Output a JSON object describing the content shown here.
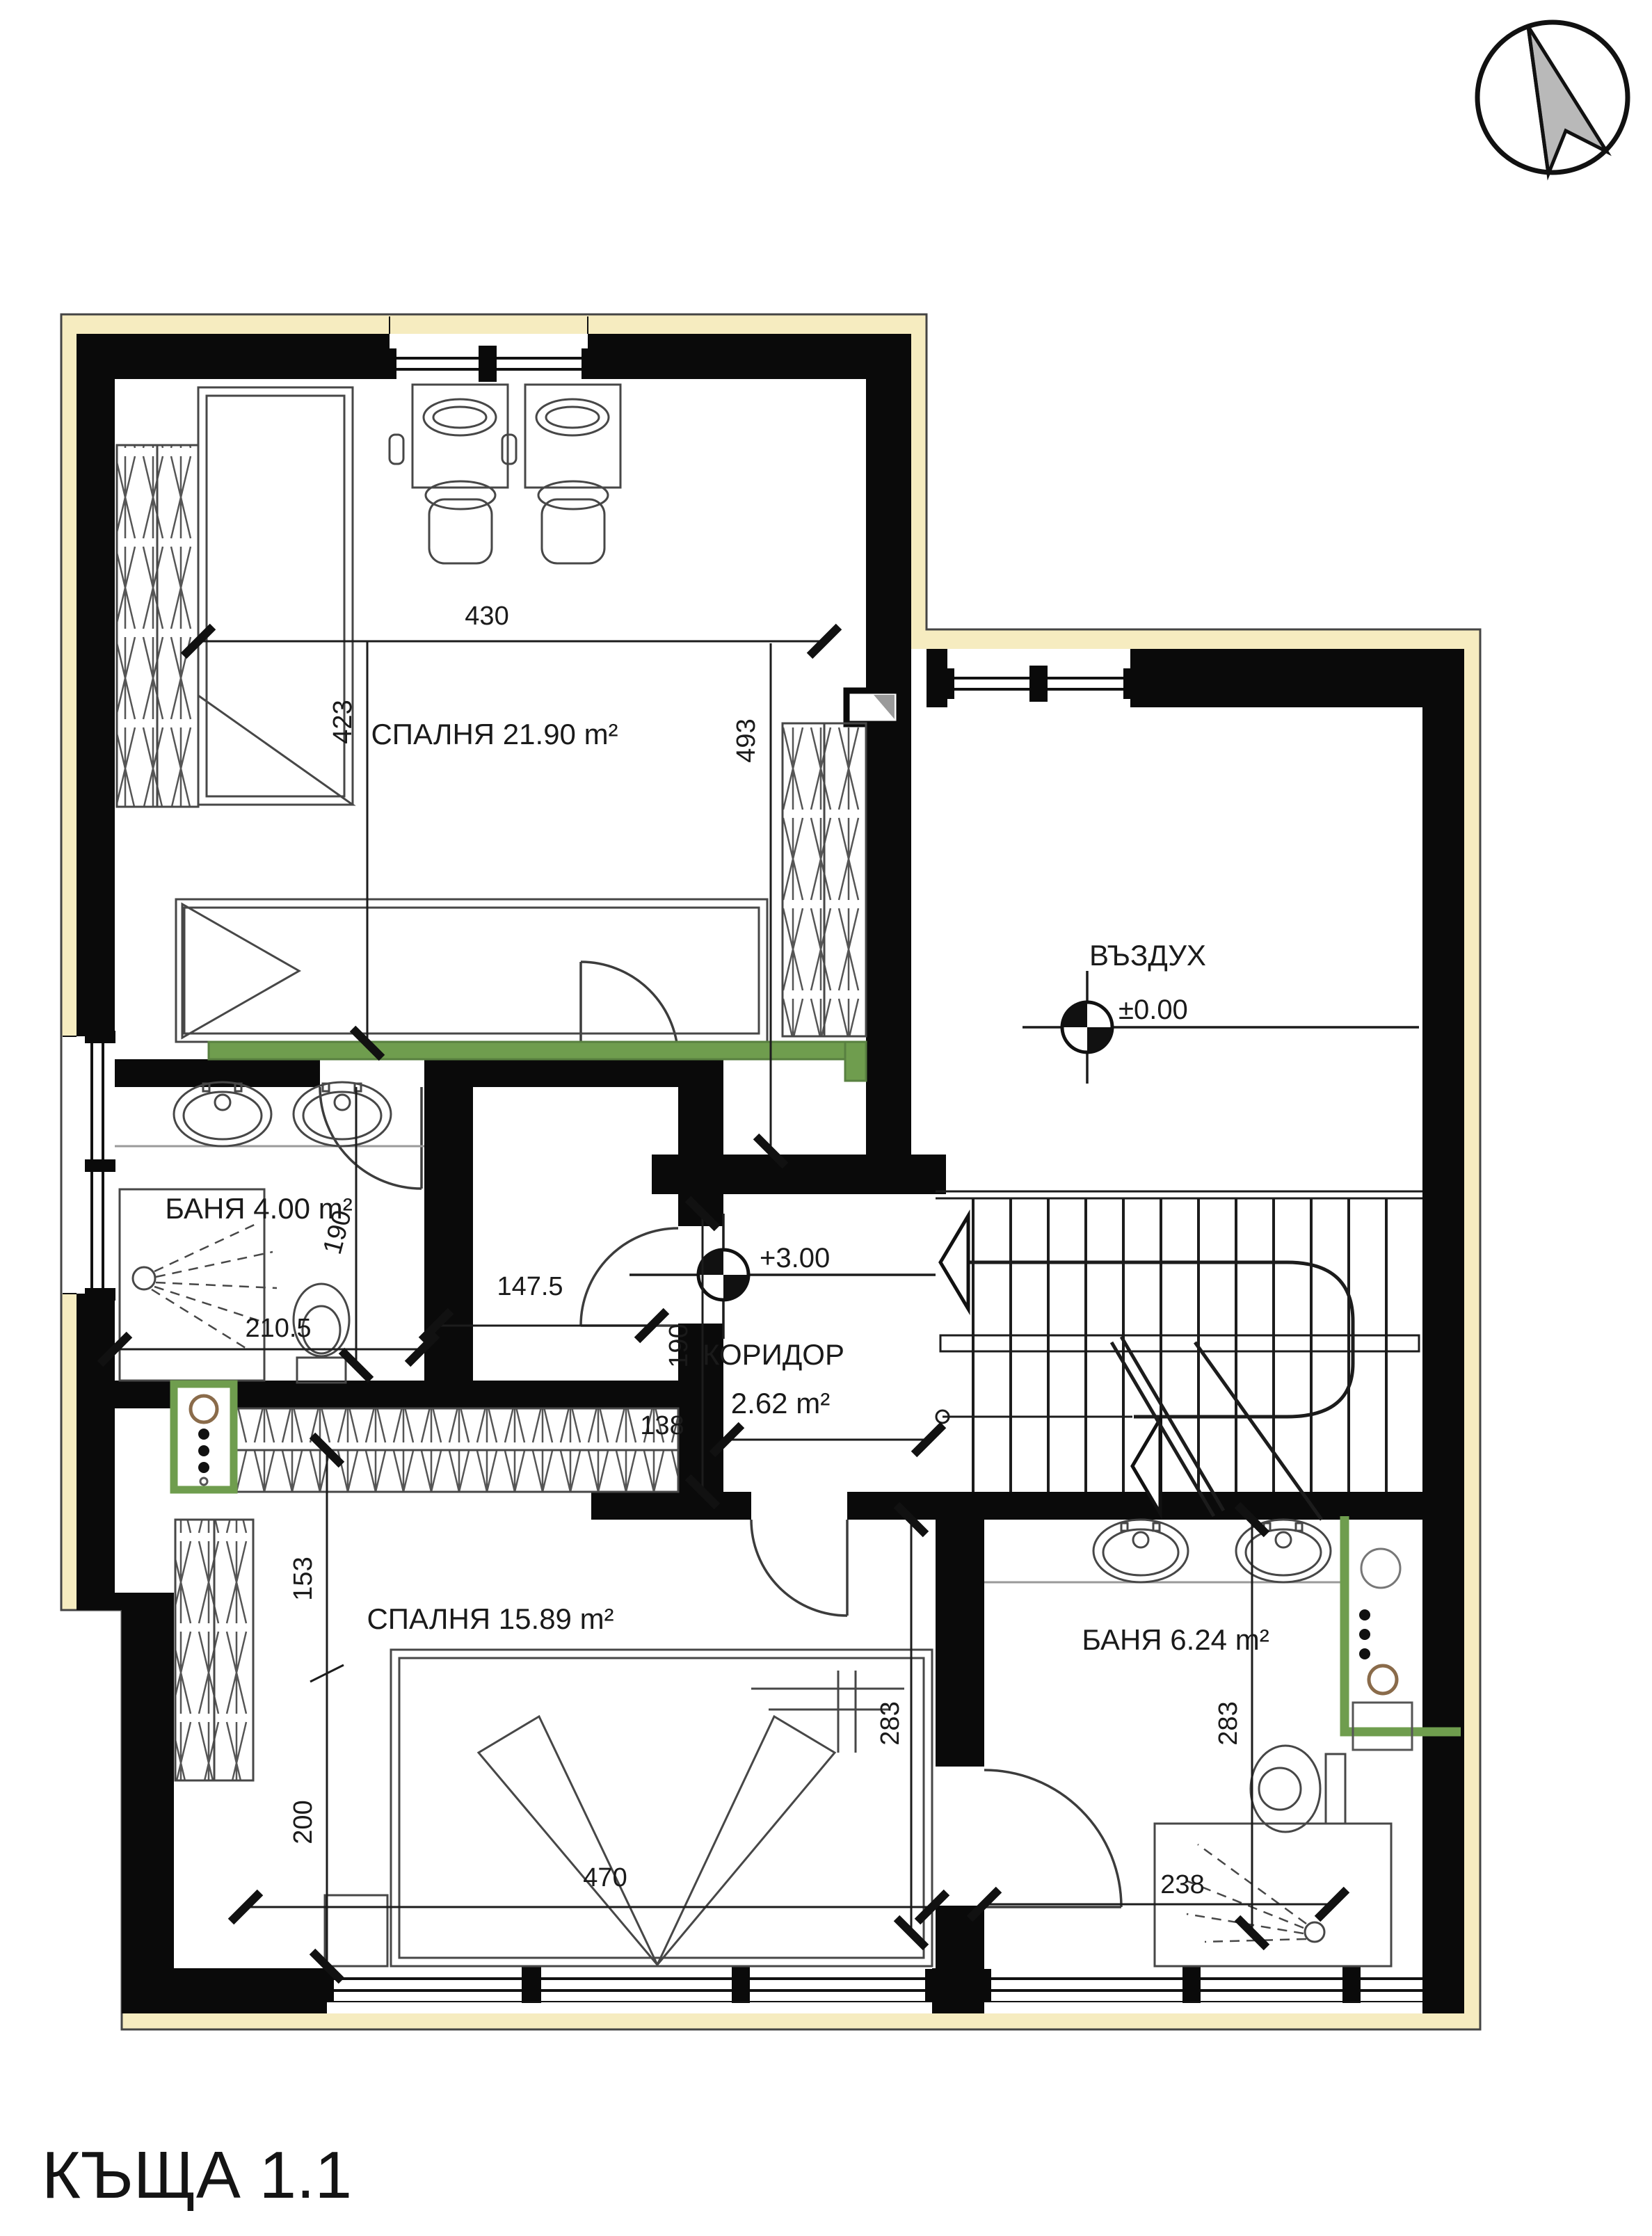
{
  "title": "КЪЩА 1.1",
  "compass": {
    "icon": "north-arrow"
  },
  "rooms": {
    "bedroom1": {
      "label": "СПАЛНЯ 21.90 m²"
    },
    "void": {
      "label": "ВЪЗДУХ",
      "level": "±0.00"
    },
    "bath1": {
      "label": "БАНЯ 4.00 m²"
    },
    "corridor": {
      "label": "КОРИДОР",
      "area": "2.62 m²",
      "level": "+3.00"
    },
    "bedroom2": {
      "label": "СПАЛНЯ 15.89 m²"
    },
    "bath2": {
      "label": "БАНЯ 6.24 m²"
    }
  },
  "dimensions": {
    "bedroom1_width": "430",
    "bedroom1_height_left": "423",
    "bedroom1_height_right": "493",
    "bath1_width": "210.5",
    "bath1_height": "190",
    "hall_width": "147.5",
    "corridor_height": "190",
    "corridor_width": "138",
    "bedroom2_upper": "153",
    "bedroom2_lower": "200",
    "bedroom2_width": "470",
    "bedroom2_height": "283",
    "bath2_height": "283",
    "bath2_width": "238"
  },
  "colors": {
    "wall": "#0a0a0a",
    "insulation": "#f6ecc0",
    "accent_green": "#6f9d4e",
    "line": "#3c3c3c"
  }
}
